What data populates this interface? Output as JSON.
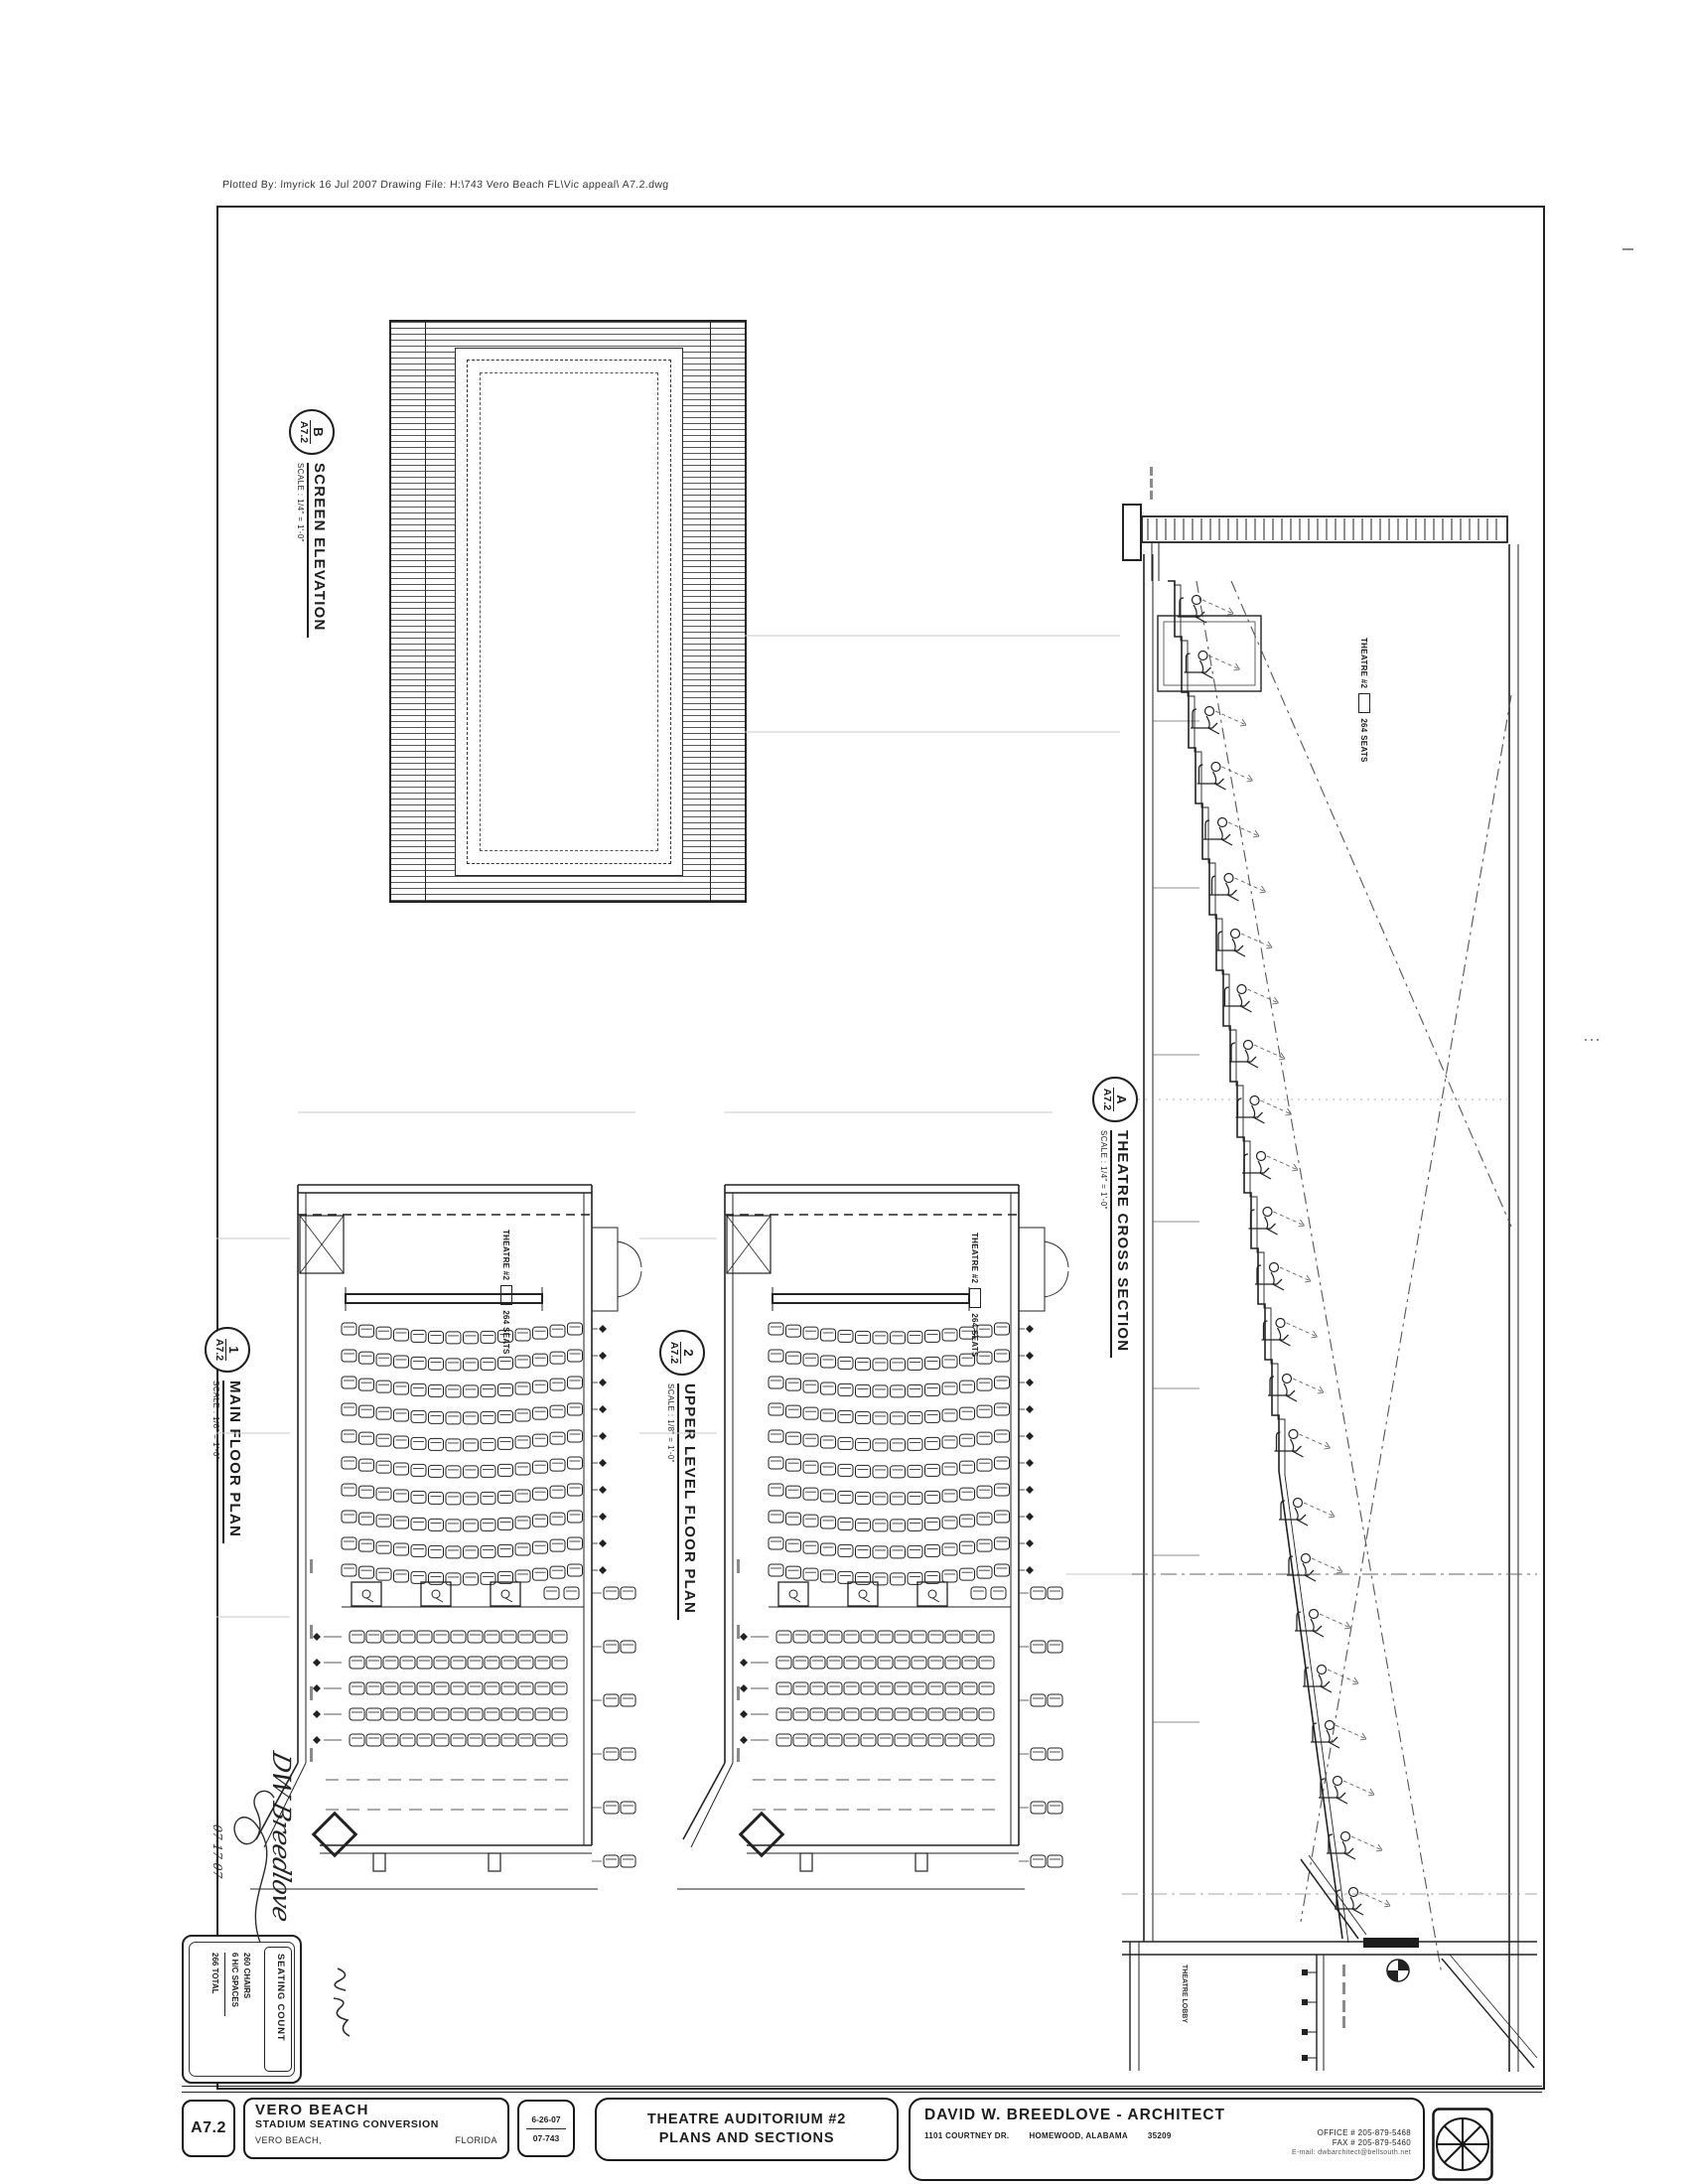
{
  "page": {
    "plot_stamp": "Plotted By: lmyrick  16 Jul 2007   Drawing File: H:\\743 Vero Beach FL\\Vic appeal\\ A7.2.dwg"
  },
  "drawings": {
    "screen_elevation": {
      "ref": "B",
      "sheet": "A7.2",
      "title": "SCREEN ELEVATION",
      "scale": "SCALE : 1/4\" = 1'-0\""
    },
    "main_floor_plan": {
      "ref": "1",
      "sheet": "A7.2",
      "title": "MAIN FLOOR PLAN",
      "scale": "SCALE : 1/8\" = 1'-0\""
    },
    "upper_level_floor_plan": {
      "ref": "2",
      "sheet": "A7.2",
      "title": "UPPER LEVEL FLOOR PLAN",
      "scale": "SCALE : 1/8\" = 1'-0\""
    },
    "theatre_cross_section": {
      "ref": "A",
      "sheet": "A7.2",
      "title": "THEATRE CROSS SECTION",
      "scale": "SCALE : 1/4\" = 1'-0\""
    }
  },
  "annotations": {
    "theatre_label_line1": "THEATRE #2",
    "theatre_label_line2": "264 SEATS",
    "lobby_note": "THEATRE LOBBY"
  },
  "seating_count": {
    "title": "SEATING COUNT",
    "chairs": "260 CHAIRS",
    "hc_spaces": "6 H/C SPACES",
    "total": "266 TOTAL"
  },
  "signature": {
    "name": "DW Breedlove",
    "date": "07-17-07"
  },
  "title_block": {
    "sheet_number": "A7.2",
    "project_name": "VERO BEACH",
    "project_subtitle": "STADIUM SEATING CONVERSION",
    "project_city": "VERO BEACH,",
    "project_state": "FLORIDA",
    "date": "6-26-07",
    "job_number": "07-743",
    "sheet_title_line1": "THEATRE AUDITORIUM #2",
    "sheet_title_line2": "PLANS AND SECTIONS",
    "architect_name": "DAVID W. BREEDLOVE - ARCHITECT",
    "architect_address": "1101 COURTNEY DR.",
    "architect_city": "HOMEWOOD, ALABAMA",
    "architect_zip": "35209",
    "office_phone": "OFFICE # 205-879-5468",
    "fax_phone": "FAX # 205-879-5460",
    "email": "E-mail: dwbarchitect@bellsouth.net"
  },
  "colors": {
    "ink": "#222222",
    "faint": "#c9c9c9",
    "dash": "#555555"
  }
}
